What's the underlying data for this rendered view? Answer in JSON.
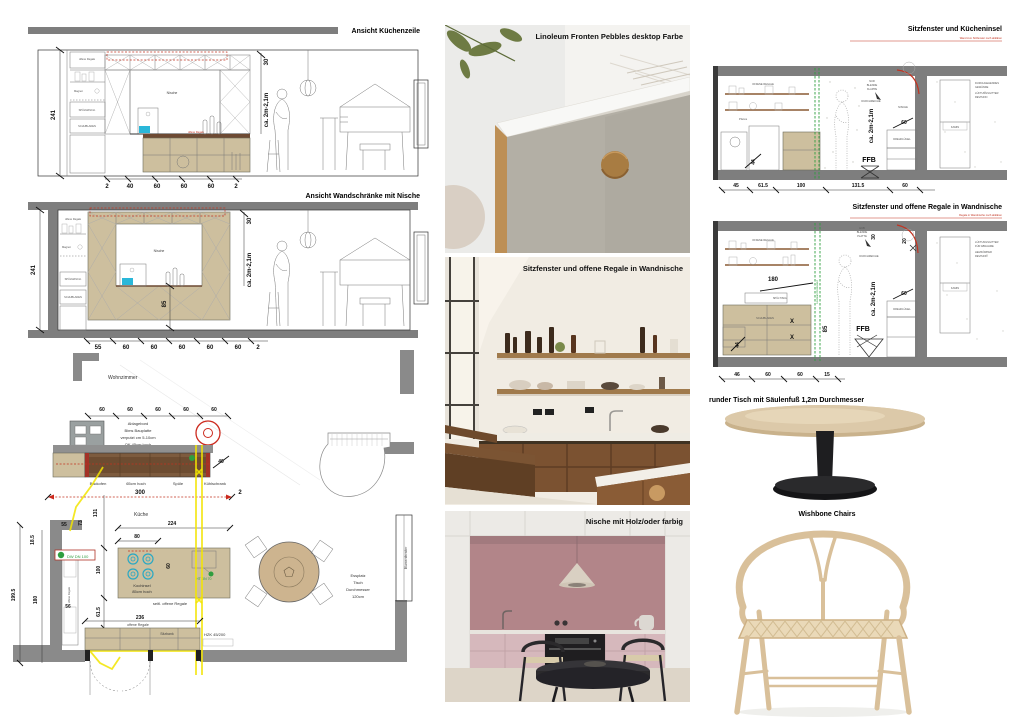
{
  "colors": {
    "wall_gray": "#7e7e7e",
    "cabinet_tan": "#cdbf9e",
    "counter_brown": "#7d5b3e",
    "accent_red": "#c23321",
    "accent_green": "#2f9e3f",
    "accent_cyan": "#2ab7d9",
    "highlight_yellow": "#f2e400",
    "photo_pink": "#b28589",
    "wood_brown": "#7b5231",
    "chair_wood": "#d9c09a"
  },
  "elevation1": {
    "title": "Ansicht Küchenzeile",
    "dim_left": "241",
    "dim_top": "30",
    "dim_range": "ca. 2m-2,1m",
    "niche": "Nische",
    "shelf_label": "offene Regale",
    "magnet": "Magnet",
    "dishwasher": "SPÜLMASCH.",
    "drawers": "SCHUBLADEN",
    "bottom_dims": [
      "2",
      "40",
      "60",
      "60",
      "60",
      "2"
    ]
  },
  "elevation2": {
    "title": "Ansicht Wandschränke mit Nische",
    "dim_left": "241",
    "dim_top": "30",
    "dim_range": "ca. 2m-2,1m",
    "dim_mid": "85",
    "niche": "Nische",
    "shelf_label": "offene Regale",
    "magnet": "Magnet",
    "dishwasher": "SPÜLMASCH.",
    "drawers": "SCHUBLADEN",
    "bottom_dims": [
      "55",
      "60",
      "60",
      "60",
      "60",
      "60",
      "2"
    ]
  },
  "floorplan": {
    "living_room": "Wohnzimmer",
    "kitchen": "Küche",
    "top_dims": [
      "60",
      "60",
      "60",
      "60",
      "60"
    ],
    "ledge_note": [
      "Ablagebord",
      "Bims Bauplatte",
      "verputzt cm 5-10cm",
      "OK 45cm hoch"
    ],
    "appliances": [
      "Backofen",
      "65cm hoch",
      "Spüle",
      "Kühlschrank"
    ],
    "dim_40": "40",
    "dim_300": "300",
    "dim_2": "2",
    "dim_224": "224",
    "dim_80": "80",
    "dim_100": "100",
    "dim_60": "60",
    "dim_236": "236",
    "island_line1": "Kochinsel",
    "island_line2": "85cm hoch",
    "island_note": "seitl. offene Regale",
    "shelf_note": "offene Regale",
    "bench": "Sitzbank",
    "hzk": "HZK 45/200",
    "pipe1": "DW DN 100",
    "pipe2": "HT DN 70",
    "dining": [
      "Essplatz",
      "Tisch",
      "Durchmesser",
      "120cm"
    ],
    "window": "Blumenfenster",
    "left_dims": {
      "d199": "199.5",
      "d180": "180",
      "d185": "18.5",
      "d55": "55",
      "d73": "73",
      "d131": "131",
      "d56": "56",
      "d615": "61.5",
      "d45": "45",
      "d605": "60.5"
    }
  },
  "photos": {
    "photo1_title": "Linoleum Fronten Pebbles desktop Farbe",
    "photo2_title": "Sitzfenster und offene Regale in Wandnische",
    "photo3_title": "Nische mit Holz/oder farbig"
  },
  "section1": {
    "title": "Sitzfenster und Kücheninsel",
    "red_note": "Wand zum Sitzfenster noch abklären",
    "open_shelves": "OFFENE REGALE",
    "pan": "Pfanne",
    "dim_44": "44",
    "dim_60": "60",
    "dim_range": "ca. 2m-2,1m",
    "niche": "NISCHE",
    "ffb": "FFB",
    "dreh": "DREHFLÜGEL",
    "durchreiche": "DURCHREICHE",
    "hub": [
      "NUR",
      "BLENDE",
      "KLAPPE"
    ],
    "kamin": "KAMIN",
    "right_note": [
      "DURCHGEHENDES",
      "GEWÄNDE",
      "LÜFTUNGSGITTER",
      "REVISION"
    ],
    "bottom_dims": [
      "45",
      "61.5",
      "100",
      "131.5",
      "60"
    ]
  },
  "section2": {
    "title": "Sitzfenster und offene Regale in Wandnische",
    "red_note": "Regale in Wandnische noch abklären",
    "open_shelves": "OFFENE REGALE",
    "sink": "SPÜLTISCH",
    "drawers": "SCHUBLADEN",
    "dim_180": "180",
    "dim_85": "85",
    "dim_30": "30",
    "dim_20": "20",
    "dim_44": "44",
    "dim_60": "60",
    "dim_range": "ca. 2m-2,1m",
    "ffb": "FFB",
    "dreh": "DREHFLÜGEL",
    "durchreiche": "DURCHREICHE",
    "hub": [
      "HUB",
      "BLENDE",
      "PLATTE"
    ],
    "kamin": "KAMIN",
    "green_note": "Linoleum Rückwand",
    "right_note": [
      "LÜFTUNGSGITTER",
      "FÜR ABNAHME",
      "HEIZKÖRPER",
      "REVISION"
    ],
    "bottom_dims": [
      "46",
      "60",
      "60",
      "15"
    ]
  },
  "table": {
    "title": "runder Tisch mit Säulenfuß 1,2m Durchmesser"
  },
  "chairs": {
    "title": "Wishbone Chairs"
  }
}
